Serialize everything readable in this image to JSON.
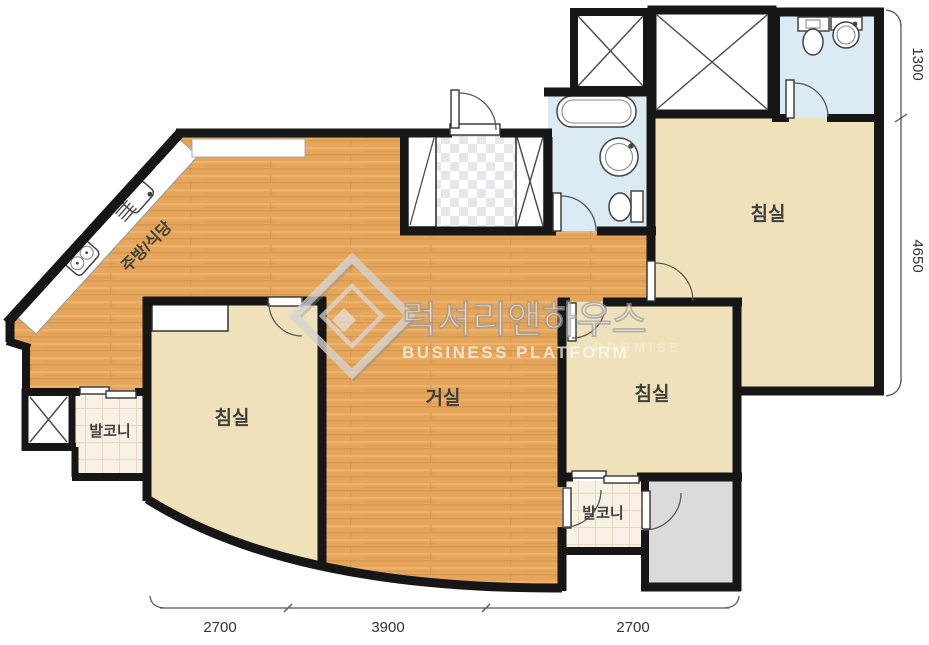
{
  "plan": {
    "rooms": {
      "kitchen": {
        "label": "주방/식당"
      },
      "living": {
        "label": "거실"
      },
      "bedroom_left": {
        "label": "침실"
      },
      "bedroom_middle": {
        "label": "침실"
      },
      "bedroom_right": {
        "label": "침실"
      },
      "balcony_left": {
        "label": "발코니"
      },
      "balcony_bottom": {
        "label": "발코니"
      }
    }
  },
  "dimensions": {
    "right": [
      {
        "value": "1300"
      },
      {
        "value": "4650"
      }
    ],
    "bottom": [
      {
        "value": "2700"
      },
      {
        "value": "3900"
      },
      {
        "value": "2700"
      }
    ]
  },
  "watermark": {
    "korean": "럭셔리앤하우스",
    "english": "BUSINESS PLATFORM",
    "ghost": "PROMISE"
  },
  "colors": {
    "background": "#FFFFFF",
    "wood": "#E5A65C",
    "bedroom": "#EFE2BB",
    "bathroom": "#DAEBF4",
    "balcony": "#F9F2E4",
    "utility": "#DBDBDE",
    "wall": "#161616"
  }
}
